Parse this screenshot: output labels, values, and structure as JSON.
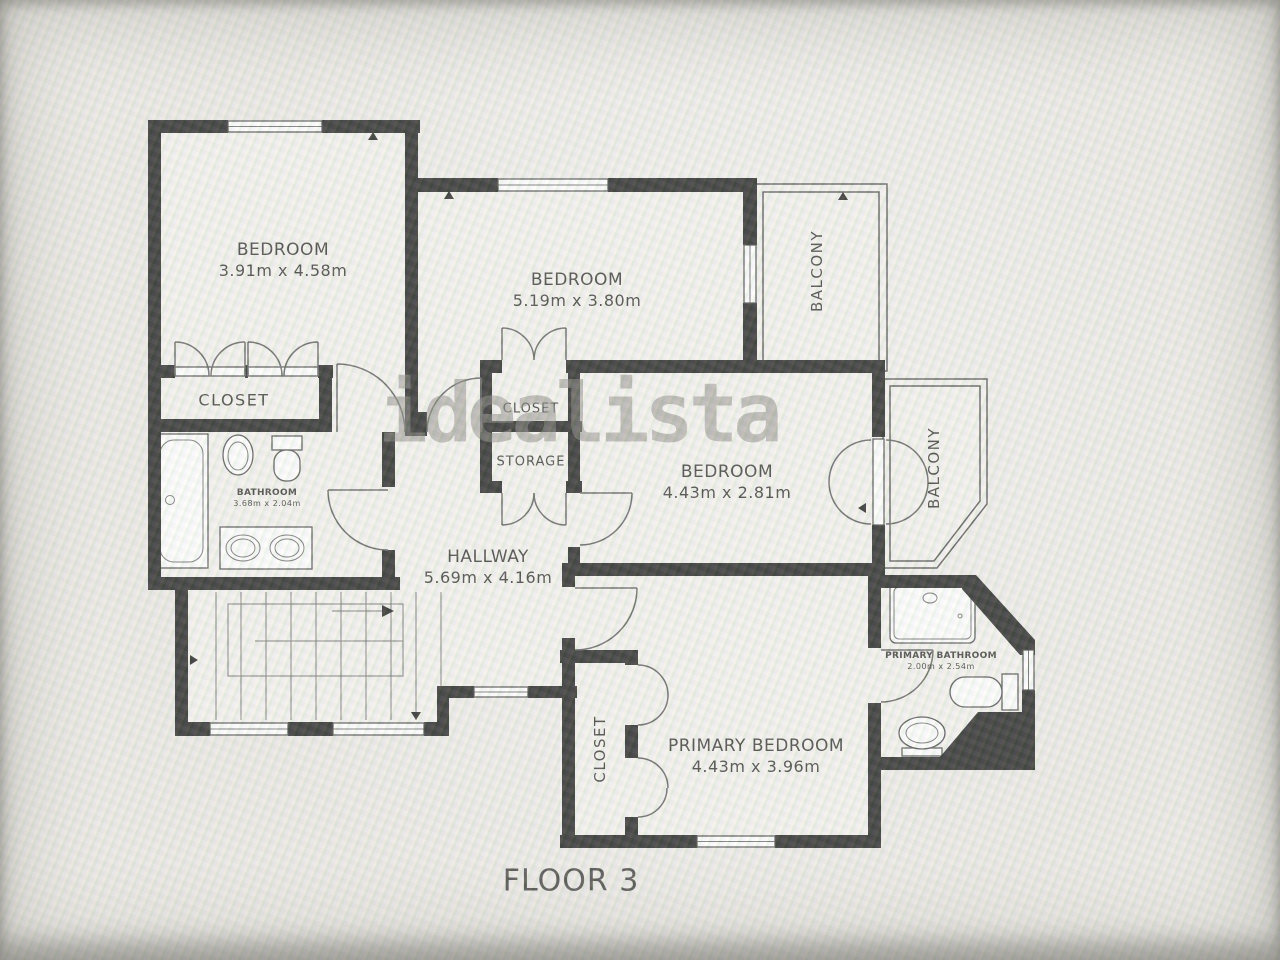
{
  "floorplan": {
    "title": "FLOOR 3",
    "watermark": "idealista",
    "rooms": {
      "bedroom1": {
        "name": "BEDROOM",
        "dims": "3.91m x 4.58m"
      },
      "bedroom2": {
        "name": "BEDROOM",
        "dims": "5.19m x 3.80m"
      },
      "bedroom3": {
        "name": "BEDROOM",
        "dims": "4.43m x 2.81m"
      },
      "primary_bedroom": {
        "name": "PRIMARY BEDROOM",
        "dims": "4.43m x 3.96m"
      },
      "hallway": {
        "name": "HALLWAY",
        "dims": "5.69m x 4.16m"
      },
      "bathroom": {
        "name": "BATHROOM",
        "dims": "3.68m x 2.04m"
      },
      "primary_bathroom": {
        "name": "PRIMARY BATHROOM",
        "dims": "2.00m x 2.54m"
      },
      "closet_bedroom1": {
        "name": "CLOSET"
      },
      "closet_hall": {
        "name": "CLOSET"
      },
      "storage": {
        "name": "STORAGE"
      },
      "closet_primary": {
        "name": "CLOSET"
      },
      "balcony_top": {
        "name": "BALCONY"
      },
      "balcony_right": {
        "name": "BALCONY"
      }
    },
    "colors": {
      "wall": "#181818",
      "floor": "#f3f2ee",
      "background": "#eae8e4",
      "line": "#555555",
      "watermark": "#8f8e88"
    }
  }
}
